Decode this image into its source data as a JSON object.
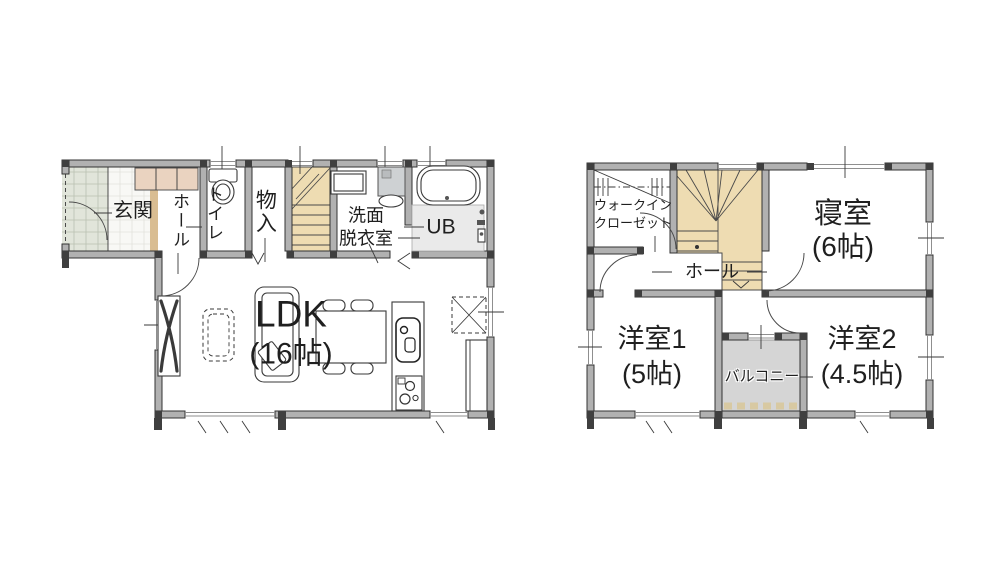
{
  "palette": {
    "bg": "#ffffff",
    "wall_fill": "#b1b1b1",
    "wall_stroke": "#333333",
    "post": "#3f3f3f",
    "line": "#3a3a3a",
    "text": "#1f1f1f",
    "stair_fill": "#eedcb2",
    "cabinet_fill": "#ead3c0",
    "threshold_fill": "#d9bd92",
    "porch_tile": "#e1e5da",
    "porch_grid": "#b9c0b1",
    "genkan_tile": "#f8f8f5",
    "genkan_grid": "#e2e2dc",
    "balcony_fill": "#d5d5d5",
    "balcony_edge": "#d8c9a2",
    "shower_fill": "#eaeaea",
    "washer_fill": "#ced1d3"
  },
  "floor1": {
    "genkan": "玄関",
    "hall": "ホール",
    "toilet": "トイレ",
    "storage": "物入",
    "washroom": [
      "洗面",
      "脱衣室"
    ],
    "bath": "UB",
    "ldk": [
      "LDK",
      "(16帖)"
    ]
  },
  "floor2": {
    "wic": [
      "ウォークイン",
      "クローゼット"
    ],
    "bedroom": [
      "寝室",
      "(6帖)"
    ],
    "hall": "ホール",
    "room1": [
      "洋室1",
      "(5帖)"
    ],
    "balcony": "バルコニー",
    "room2": [
      "洋室2",
      "(4.5帖)"
    ]
  }
}
